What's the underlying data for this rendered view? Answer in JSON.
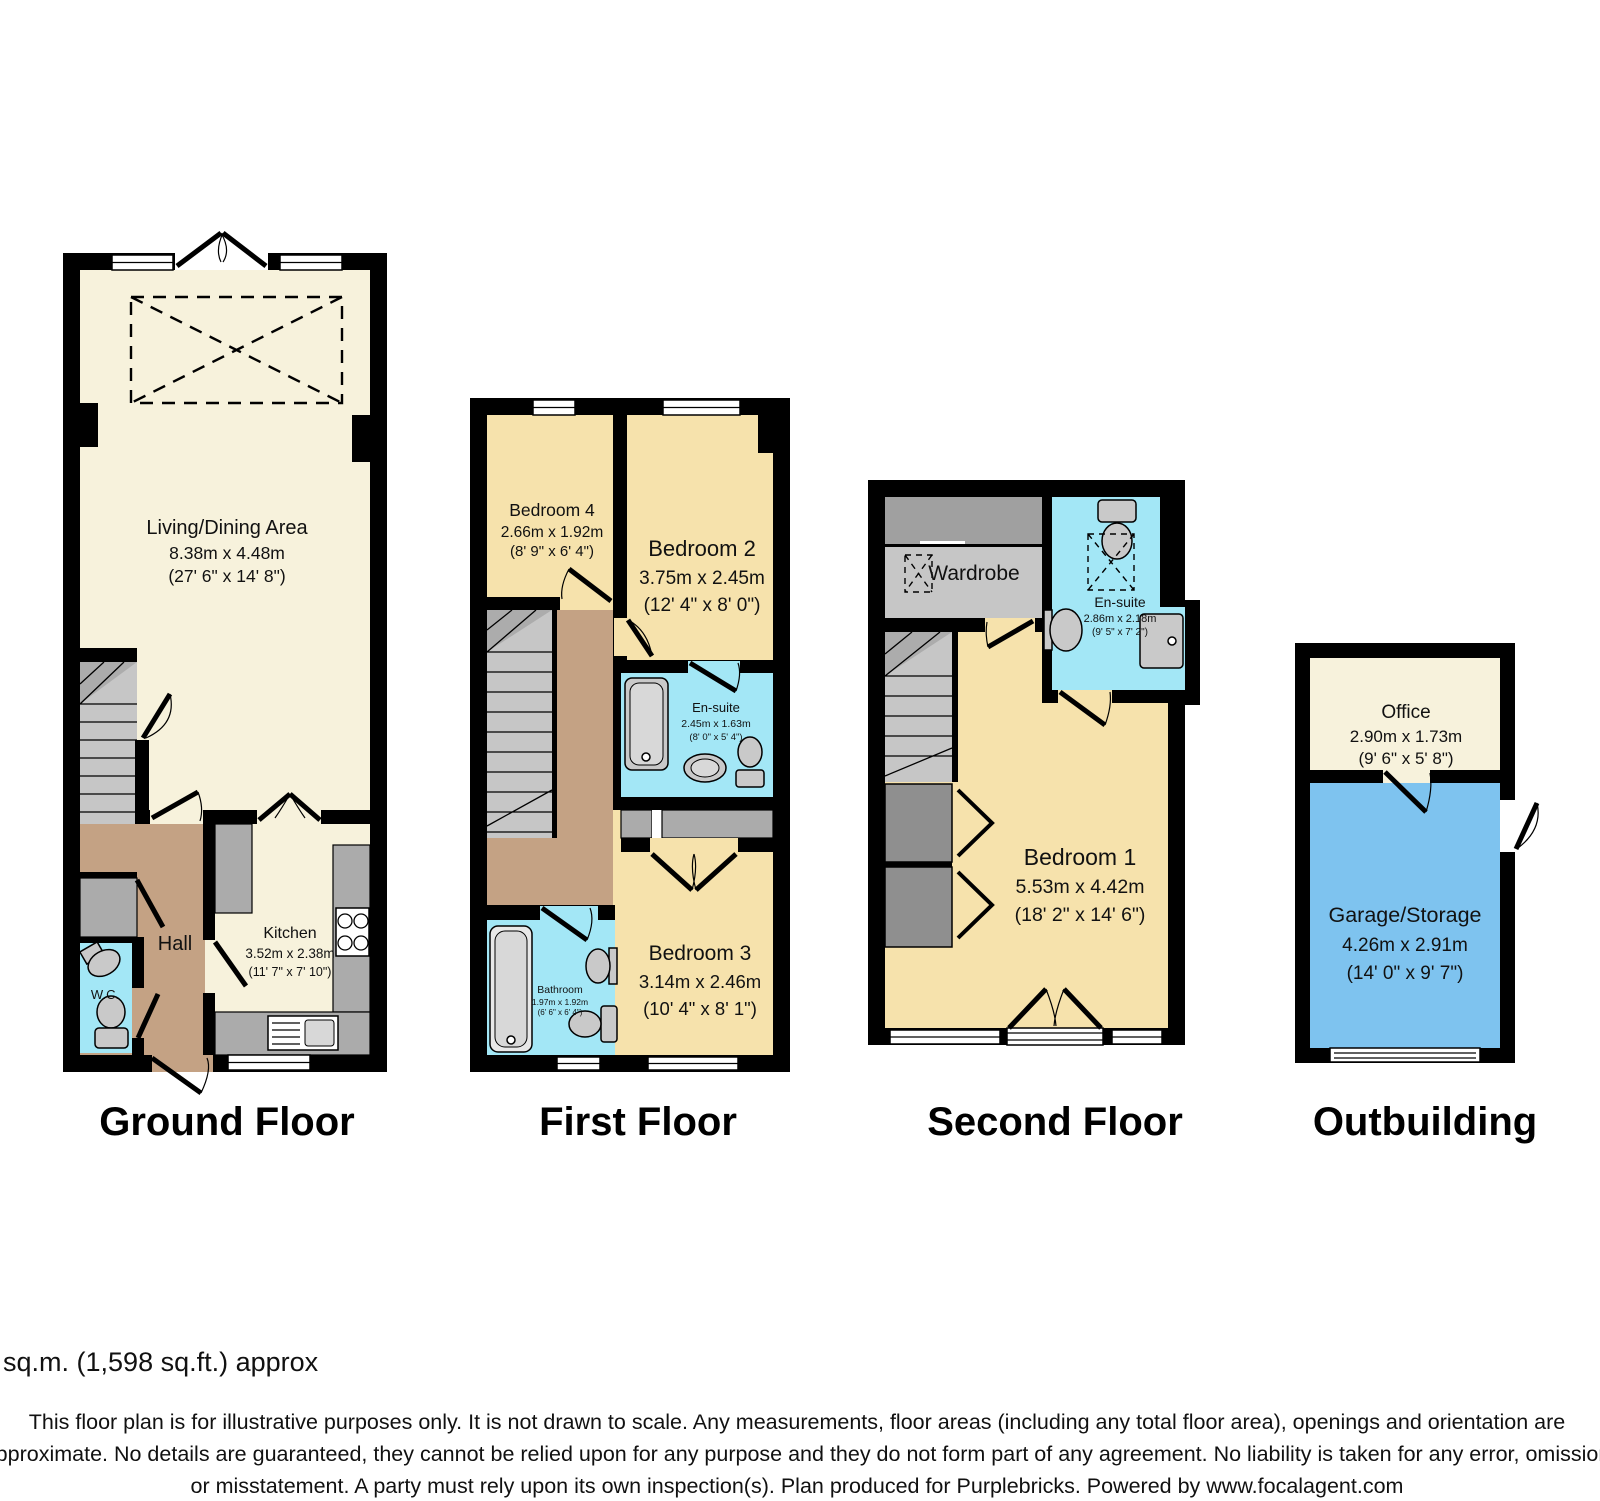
{
  "colors": {
    "wall": "#000000",
    "living_cream": "#F7F2DC",
    "bedroom_tan": "#F6E2AC",
    "hall_brown": "#C4A284",
    "wet_room_blue": "#A3E7F6",
    "garage_blue": "#7EC3EF",
    "stairs_gray": "#C6C6C6",
    "counter_gray": "#ABABAB",
    "eaves_gray": "#8F8F8F"
  },
  "ground": {
    "title": "Ground Floor",
    "living": {
      "name": "Living/Dining Area",
      "metric": "8.38m x 4.48m",
      "imperial": "(27' 6\" x 14' 8\")"
    },
    "kitchen": {
      "name": "Kitchen",
      "metric": "3.52m x 2.38m",
      "imperial": "(11' 7\" x 7' 10\")"
    },
    "hall": {
      "name": "Hall"
    },
    "wc": {
      "name": "W.C."
    }
  },
  "first": {
    "title": "First Floor",
    "bedroom4": {
      "name": "Bedroom 4",
      "metric": "2.66m x 1.92m",
      "imperial": "(8' 9\" x 6' 4\")"
    },
    "bedroom2": {
      "name": "Bedroom 2",
      "metric": "3.75m x 2.45m",
      "imperial": "(12' 4\" x 8' 0\")"
    },
    "ensuite": {
      "name": "En-suite",
      "metric": "2.45m x 1.63m",
      "imperial": "(8' 0\" x 5' 4\")"
    },
    "bathroom": {
      "name": "Bathroom",
      "metric": "1.97m x 1.92m",
      "imperial": "(6' 6\" x 6' 4\")"
    },
    "bedroom3": {
      "name": "Bedroom 3",
      "metric": "3.14m x 2.46m",
      "imperial": "(10' 4\" x 8' 1\")"
    }
  },
  "second": {
    "title": "Second Floor",
    "wardrobe": {
      "name": "Wardrobe"
    },
    "ensuite": {
      "name": "En-suite",
      "metric": "2.86m x 2.18m",
      "imperial": "(9' 5\" x 7' 2\")"
    },
    "bedroom1": {
      "name": "Bedroom 1",
      "metric": "5.53m x 4.42m",
      "imperial": "(18' 2\" x 14' 6\")"
    }
  },
  "outbuilding": {
    "title": "Outbuilding",
    "office": {
      "name": "Office",
      "metric": "2.90m x 1.73m",
      "imperial": "(9' 6\" x 5' 8\")"
    },
    "garage": {
      "name": "Garage/Storage",
      "metric": "4.26m x 2.91m",
      "imperial": "(14' 0\" x 9' 7\")"
    }
  },
  "footer": {
    "total_area": "Total floor area 148.5 sq.m. (1,598 sq.ft.) approx",
    "disclaimer_line1": "This floor plan is for illustrative purposes only. It is not drawn to scale. Any measurements, floor areas (including any total floor area), openings and orientation are",
    "disclaimer_line2": "approximate. No details are guaranteed, they cannot be relied upon for any purpose and they do not form part of any agreement. No liability is taken for any error, omission",
    "disclaimer_line3": "or misstatement. A party must rely upon its own inspection(s). Plan produced for Purplebricks. Powered by www.focalagent.com"
  }
}
